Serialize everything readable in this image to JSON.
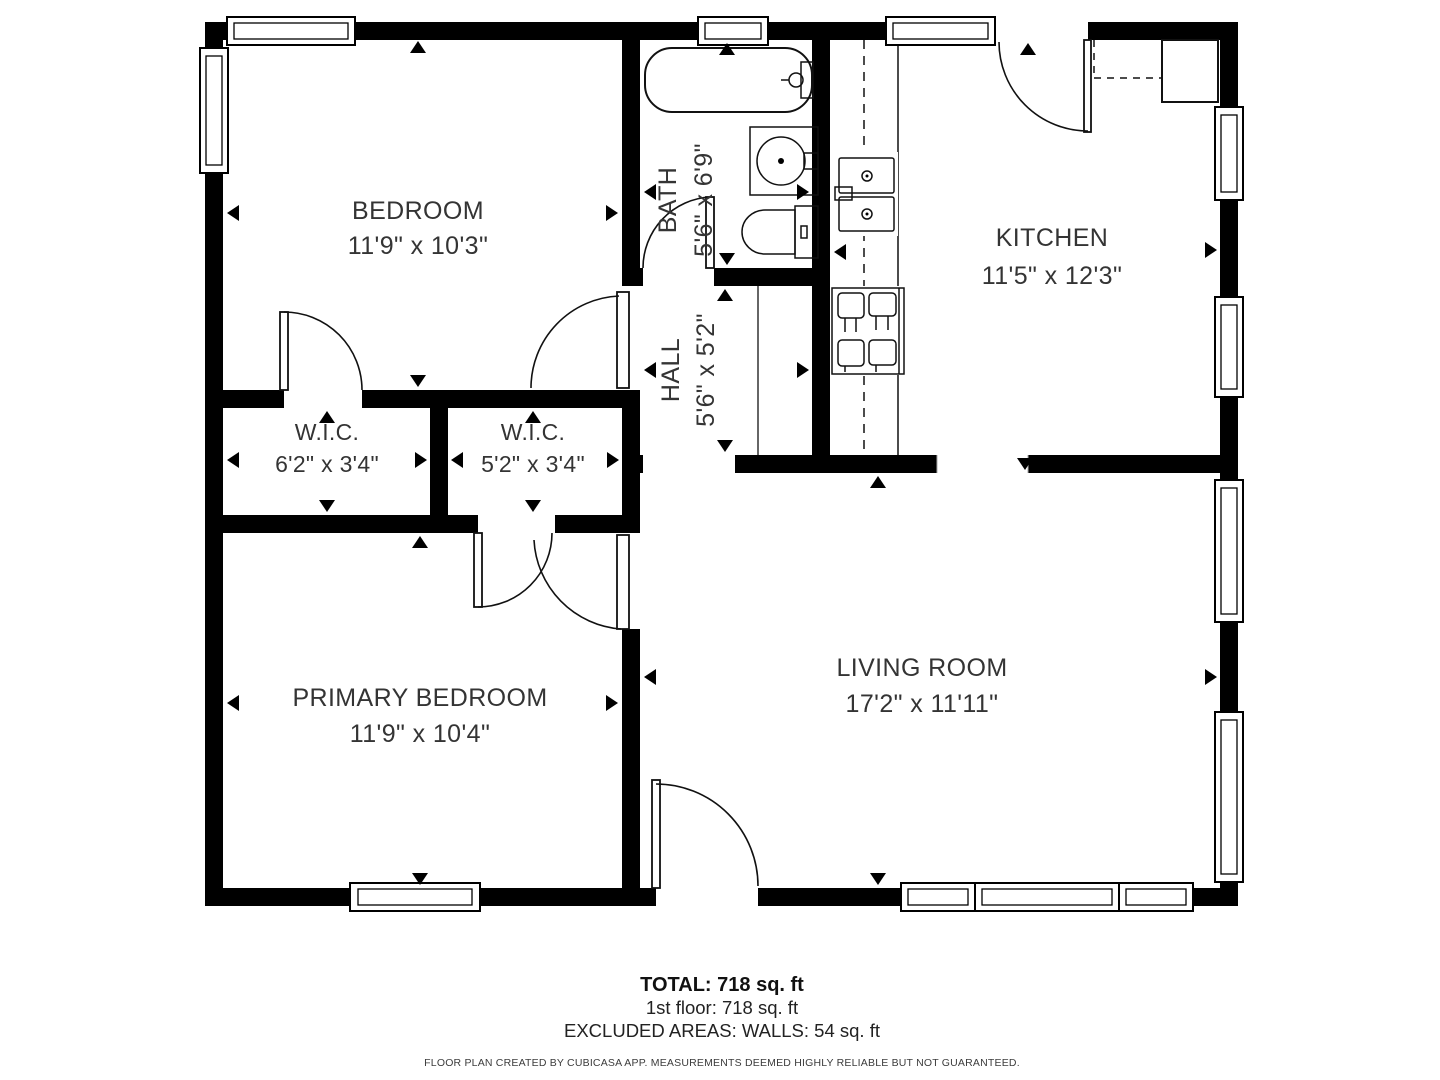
{
  "colors": {
    "wall": "#000000",
    "background": "#ffffff",
    "text": "#343434"
  },
  "rooms": {
    "bedroom": {
      "name": "BEDROOM",
      "dims": "11'9\" x 10'3\""
    },
    "bath": {
      "name": "BATH",
      "dims": "5'6\" x 6'9\""
    },
    "kitchen": {
      "name": "KITCHEN",
      "dims": "11'5\" x 12'3\""
    },
    "hall": {
      "name": "HALL",
      "dims": "5'6\" x 5'2\""
    },
    "wic_left": {
      "name": "W.I.C.",
      "dims": "6'2\" x 3'4\""
    },
    "wic_right": {
      "name": "W.I.C.",
      "dims": "5'2\" x 3'4\""
    },
    "primary_bedroom": {
      "name": "PRIMARY BEDROOM",
      "dims": "11'9\" x 10'4\""
    },
    "living_room": {
      "name": "LIVING ROOM",
      "dims": "17'2\" x 11'11\""
    }
  },
  "footer": {
    "total": "TOTAL: 718 sq. ft",
    "floor": "1st floor: 718 sq. ft",
    "excluded": "EXCLUDED AREAS: WALLS: 54 sq. ft",
    "disclaimer": "FLOOR PLAN CREATED BY CUBICASA APP. MEASUREMENTS DEEMED HIGHLY RELIABLE BUT NOT GUARANTEED."
  }
}
